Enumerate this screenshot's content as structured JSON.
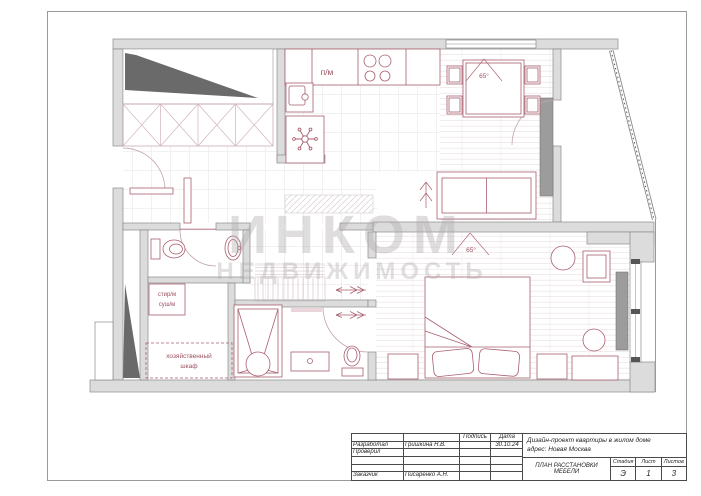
{
  "canvas": {
    "width": 701,
    "height": 496
  },
  "colors": {
    "furniture_accent": "#a95f6f",
    "label_accent": "#9c5060",
    "wall_fill": "#dcdcdc",
    "wall_stroke": "#8a8a8a",
    "dark_structure": "#6a6a6a",
    "cabinet_gray": "#9c9c9c",
    "watermark_gray": "#b3aeb0"
  },
  "watermark": {
    "line1": "ИНКОМ",
    "line2": "НЕДВИЖИМОСТЬ"
  },
  "plan_labels": {
    "kitchen_dishwasher": "п/м",
    "living_tv_size": "65°",
    "bedroom_tv_size": "65°",
    "laundry_washer": "стир/м",
    "laundry_dryer": "суш/м",
    "utility_closet_line1": "хозяйственный",
    "utility_closet_line2": "шкаф"
  },
  "title_block": {
    "developed_label": "Разработал",
    "developed_name": "Гришкина Н.В.",
    "checked_label": "Проверил",
    "client_label": "Заказчик",
    "client_name": "Писаренко А.Н.",
    "signature_header": "Подпись",
    "date_header": "Дата",
    "date_value": "30.10.24",
    "project_line1": "Дизайн-проект квартиры в жилом доме",
    "project_line2": "адрес: Новая Москва",
    "drawing_title": "ПЛАН РАССТАНОВКИ МЕБЕЛИ",
    "stage_header": "Стадия",
    "stage_value": "Э",
    "sheet_header": "Лист",
    "sheet_value": "1",
    "sheets_header": "Листов",
    "sheets_value": "3"
  }
}
